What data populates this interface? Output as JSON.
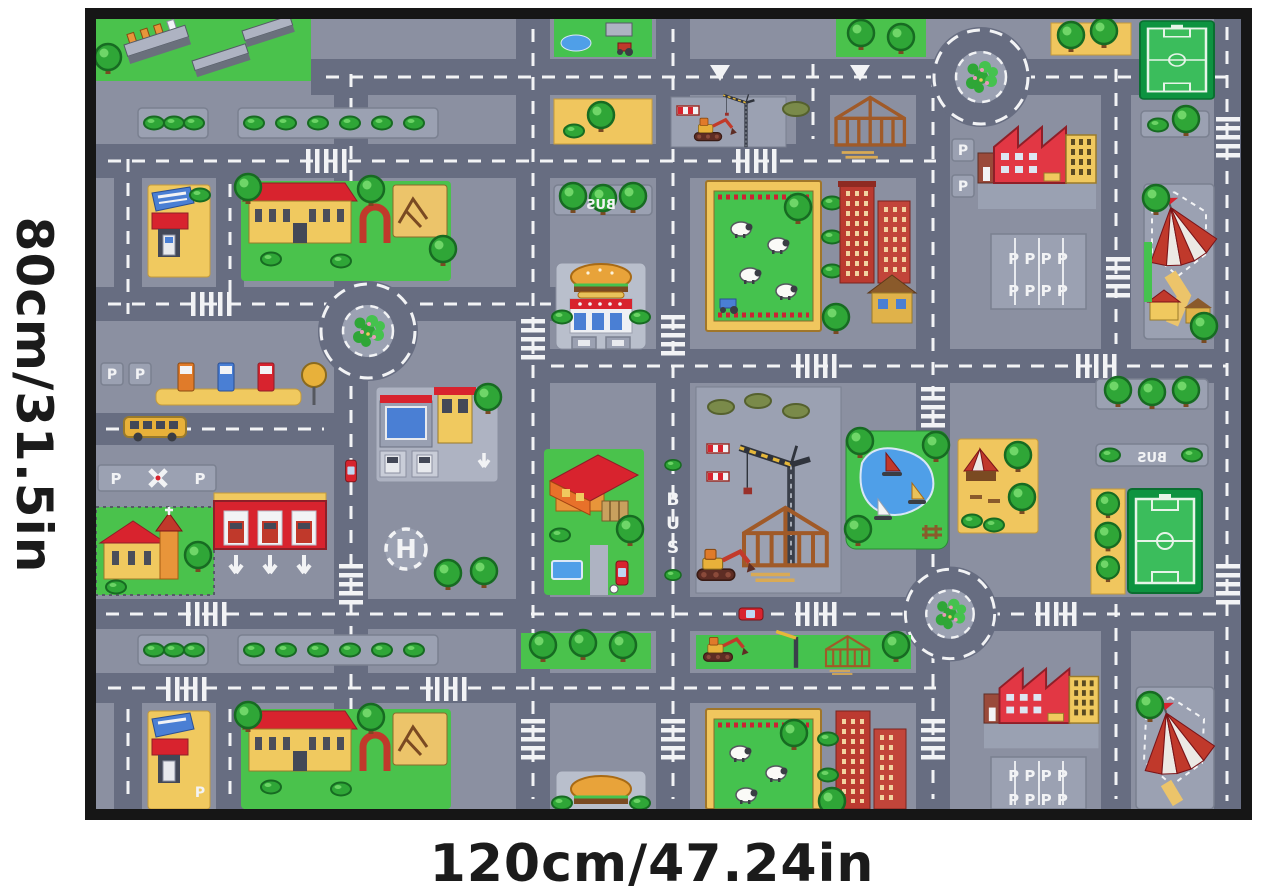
{
  "labels": {
    "height": "80cm/31.5in",
    "width": "120cm/47.24in"
  },
  "mat_markings": {
    "p": "P",
    "p_row": "P P P P",
    "bus": "BUS",
    "bus_b": "B",
    "bus_u": "U",
    "bus_s": "S",
    "h": "H"
  },
  "colors": {
    "frame": "#161616",
    "mat_base": "#8B90A1",
    "road": "#676D81",
    "median": "#9BA1B2",
    "marking_white": "#F2F3F5",
    "grass": "#4AC24C",
    "tree": "#2FA637",
    "yellow": "#F0C65E",
    "red": "#D8232E",
    "factory_red": "#E23744",
    "brick": "#BB3A30",
    "blue": "#4A7FD4",
    "water": "#4F9FE8",
    "pitch_dark": "#0D9340",
    "pitch_light": "#3BBD5C",
    "sand": "#ECC46A"
  },
  "landmarks": [
    "apartment-complex",
    "car-wash",
    "mansion-with-playground",
    "sandbox",
    "burger-restaurant",
    "sheep-pasture",
    "brick-apartments",
    "factory",
    "parking-lot",
    "circus-tent",
    "soccer-field",
    "roundabout",
    "gas-station",
    "school-bus",
    "church",
    "car-dealership",
    "fire-station",
    "helipad",
    "family-house-with-pool",
    "bus-lane",
    "construction-site",
    "tower-crane",
    "excavator",
    "timber-house-frame",
    "pond-with-sailboats",
    "market-square",
    "farm-with-pond",
    "tree-median",
    "zebra-crossing"
  ]
}
